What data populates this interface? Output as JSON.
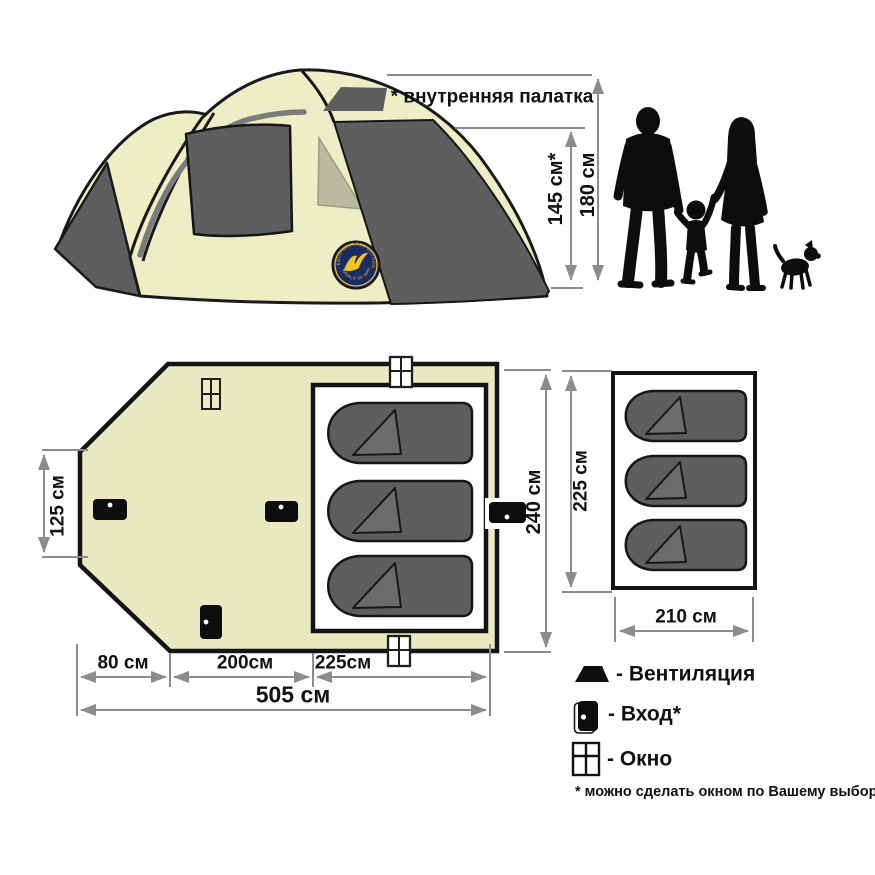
{
  "annotations": {
    "inner_tent_note": "* внутренняя палатка"
  },
  "side_view": {
    "inner_height": "145 см*",
    "outer_height": "180 см"
  },
  "floor_plan": {
    "left_width": "125 см",
    "depth": "240 см",
    "back_section": "80 см",
    "mid_section": "200см",
    "front_section": "225см",
    "total_length": "505 см"
  },
  "inner_room": {
    "height": "225 см",
    "width": "210 см"
  },
  "logo": {
    "arc_top": "EQUIPMENT FOR OUTDOOR & FISHING",
    "arc_bottom": "WORLD OF MAVERICK"
  },
  "legend": {
    "items": [
      {
        "icon": "vent-icon",
        "label": "- Вентиляция"
      },
      {
        "icon": "door-icon",
        "label": "- Вход*"
      },
      {
        "icon": "window-icon",
        "label": "- Окно"
      }
    ],
    "footnote": "* можно сделать окном по Вашему выбору"
  },
  "colors": {
    "tent_fabric": "#EDEEC6",
    "plan_floor": "#E9EAC1",
    "panel_dark": "#5E5E5E",
    "window_light": "#B9BA9E",
    "dimension_gray": "#8C8C8C",
    "silhouette": "#0D0D0D",
    "logo_navy": "#1C2B66",
    "logo_yellow": "#F2C51D"
  }
}
